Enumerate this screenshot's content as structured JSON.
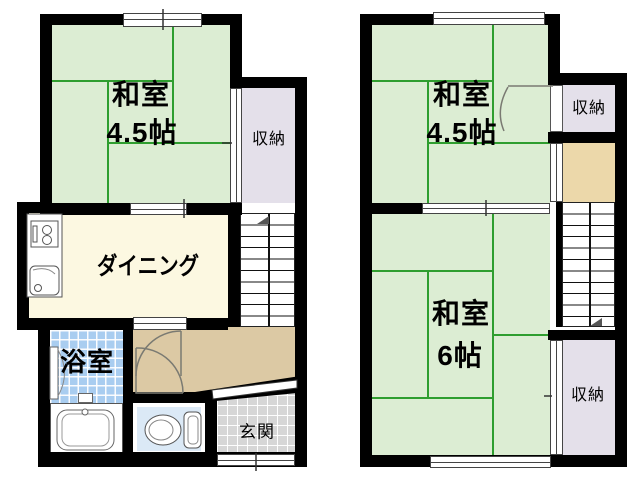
{
  "floor1": {
    "washitsu": {
      "name": "和室",
      "size": "4.5帖"
    },
    "storage_label": "収納",
    "dining_label": "ダイニング",
    "bath_label": "浴室",
    "entrance_label": "玄関"
  },
  "floor2": {
    "washitsu_small": {
      "name": "和室",
      "size": "4.5帖"
    },
    "washitsu_large": {
      "name": "和室",
      "size": "6帖"
    },
    "storage_top_label": "収納",
    "storage_bottom_label": "収納"
  },
  "colors": {
    "tatami_green": "#dcedd3",
    "tatami_line_green": "#2f9e2f",
    "storage_lavender": "#e4e0ea",
    "dining_cream": "#fcf8e1",
    "hall_tan": "#dcc9a4",
    "closet_beige": "#ecd8aa",
    "bath_blue": "#a9cdf0",
    "toilet_blue": "#dbe9f6",
    "entrance_gray": "#d6d6d6",
    "wall_black": "#000000"
  }
}
